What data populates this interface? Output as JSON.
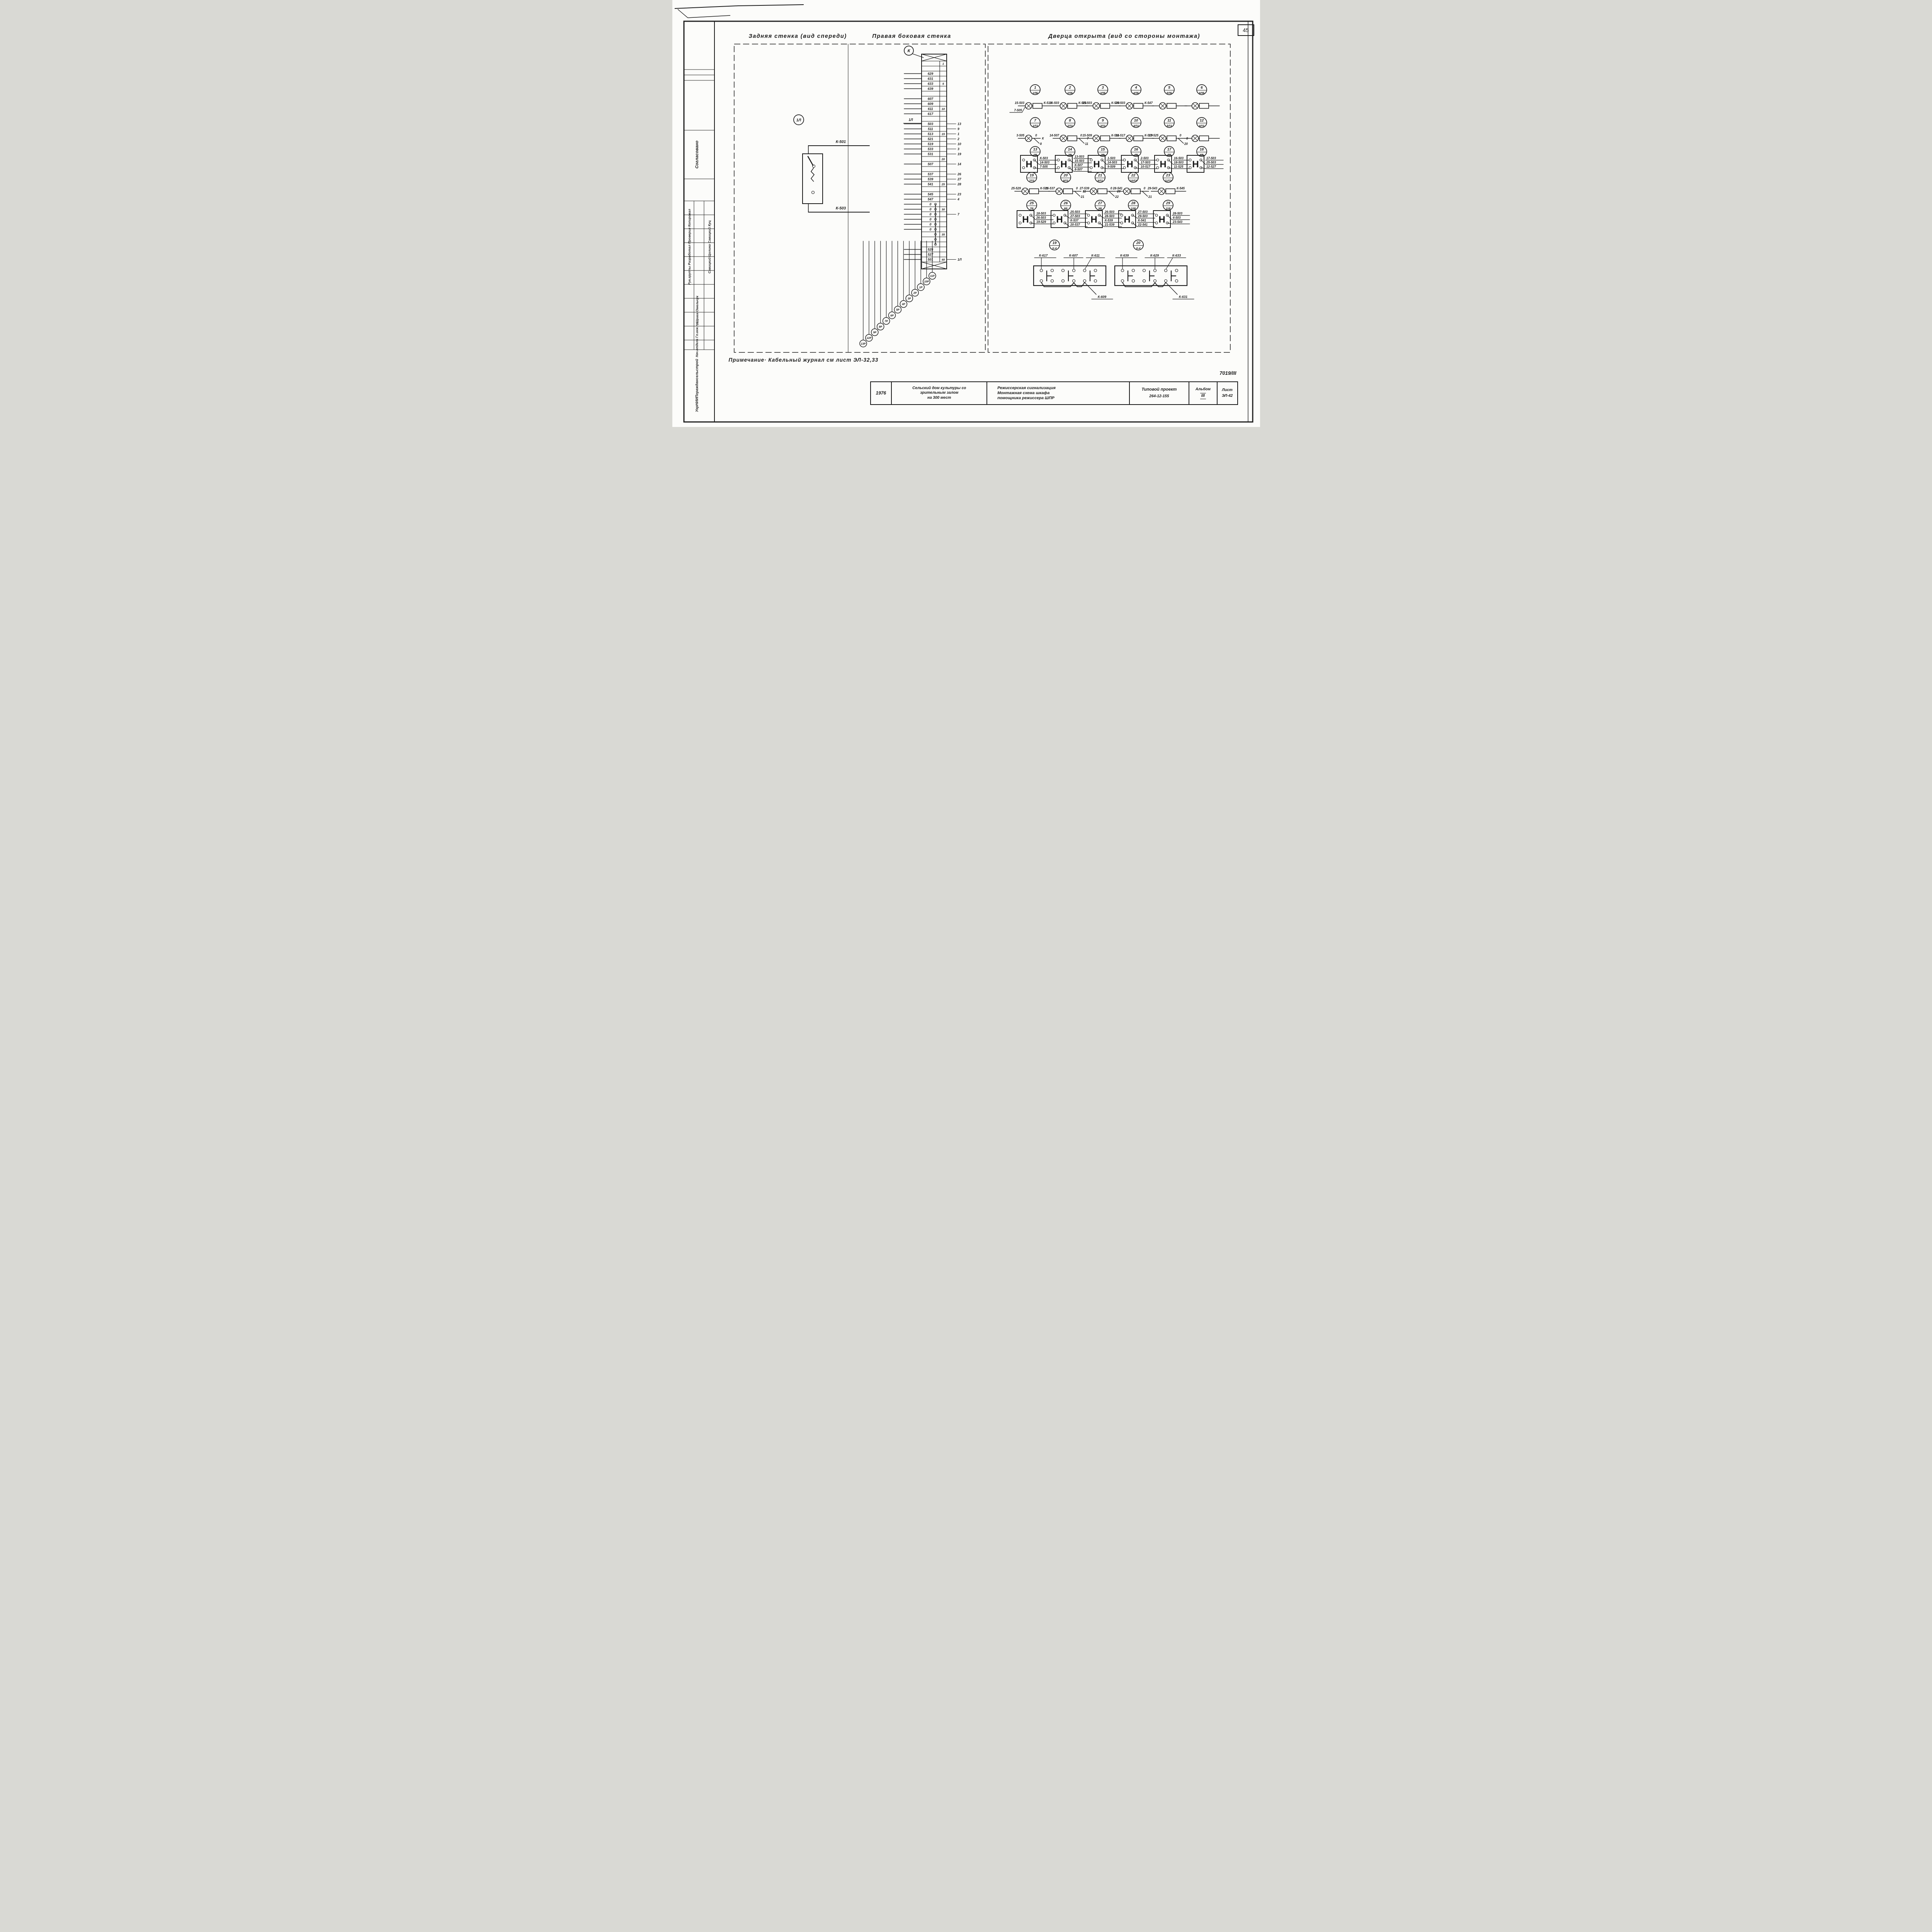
{
  "page": {
    "number": "45",
    "doc_code": "7019/III",
    "note": "Примечание·  Кабельный журнал  см лист ЭЛ-32,33"
  },
  "section_titles": [
    "Задняя стенка (вид спереди)",
    "Правая боковая стенка",
    "Дверца открыта (вид со стороны монтажа)"
  ],
  "back_wall": {
    "feeder_circle": "1Л",
    "wire_top": "К-501",
    "wire_bottom": "К-503"
  },
  "side_wall": {
    "connector_circle": "К",
    "strip_side_label": "1Л",
    "terminals": [
      {
        "i": "1"
      },
      {},
      {
        "t": "629"
      },
      {
        "t": "631"
      },
      {
        "t": "633",
        "i": "5"
      },
      {
        "t": "639"
      },
      {},
      {
        "t": "607"
      },
      {
        "t": "609"
      },
      {
        "t": "611",
        "i": "10"
      },
      {
        "t": "617"
      },
      {},
      {
        "t": "503",
        "r": "13"
      },
      {
        "t": "511",
        "r": "9"
      },
      {
        "t": "513",
        "i": "15",
        "r": "1"
      },
      {
        "t": "521",
        "r": "2"
      },
      {
        "t": "519",
        "r": "10"
      },
      {
        "t": "533",
        "r": "3"
      },
      {
        "t": "531",
        "r": "19"
      },
      {
        "i": "20"
      },
      {
        "t": "507",
        "r": "14"
      },
      {},
      {
        "t": "537",
        "r": "26"
      },
      {
        "t": "539",
        "r": "27"
      },
      {
        "t": "541",
        "i": "25",
        "r": "28"
      },
      {},
      {
        "t": "545",
        "r": "23"
      },
      {
        "t": "547",
        "r": "4"
      },
      {
        "t": "0",
        "j": 1
      },
      {
        "t": "0",
        "i": "30",
        "j": 1
      },
      {
        "t": "0",
        "r": "7",
        "j": 1
      },
      {
        "t": "0",
        "j": 1
      },
      {
        "t": "0",
        "j": 1
      },
      {
        "t": "0",
        "j": 1
      },
      {
        "i": "35",
        "j": 1
      },
      {
        "j": 1
      },
      {
        "j": 1
      },
      {
        "t": "525"
      },
      {
        "t": "527"
      },
      {
        "t": "501",
        "i": "40",
        "r": "1Л"
      }
    ],
    "cable_tags": [
      "13Р",
      "12Р",
      "9Р",
      "8Р",
      "7Р",
      "6Р",
      "5Р",
      "4Р",
      "3Р",
      "2Р",
      "1Р",
      "10Р",
      "11Р"
    ]
  },
  "door": {
    "h_letter": "Н",
    "circle_rows": [
      [
        {
          "n": "1",
          "c": "1ЛБ"
        },
        {
          "n": "2",
          "c": "2ЛБ"
        },
        {
          "n": "3",
          "c": "3ЛБ"
        },
        {
          "n": "4",
          "c": "4ЛБ"
        },
        {
          "n": "5",
          "c": "5ЛБ"
        },
        {
          "n": "6",
          "c": "6ЛБ"
        }
      ],
      [
        {
          "n": "7",
          "c": "1ЛЗ"
        },
        {
          "n": "8",
          "c": "2ЛЗ"
        },
        {
          "n": "9",
          "c": "3ЛЗ"
        },
        {
          "n": "10",
          "c": "4ЛЗ"
        },
        {
          "n": "11",
          "c": "5ЛЗ"
        },
        {
          "n": "12",
          "c": "6ЛЗ"
        }
      ],
      [
        {
          "n": "13",
          "c": "1В"
        },
        {
          "n": "14",
          "c": "2В"
        },
        {
          "n": "15",
          "c": "3В"
        },
        {
          "n": "16",
          "c": "4В"
        },
        {
          "n": "17",
          "c": "5В"
        },
        {
          "n": "18",
          "c": "6В"
        }
      ],
      [
        {
          "n": "19",
          "c": "7ЛЗ"
        },
        {
          "n": "20",
          "c": "8ЛЗ"
        },
        {
          "n": "21",
          "c": "9ЛЗ"
        },
        {
          "n": "22",
          "c": "10ЛЗ"
        },
        {
          "n": "23",
          "c": "11ЛЗ"
        }
      ],
      [
        {
          "n": "25",
          "c": "7В"
        },
        {
          "n": "26",
          "c": "8В"
        },
        {
          "n": "27",
          "c": "9В"
        },
        {
          "n": "28",
          "c": "10В"
        },
        {
          "n": "29",
          "c": "11В"
        }
      ],
      [
        {
          "n": "19",
          "c": "К-4"
        },
        {
          "n": "20",
          "c": "К-4"
        }
      ]
    ],
    "lamp_chains": [
      [
        {
          "pre": "15-503",
          "pre2": "7-505",
          "box": 1,
          "post": "К-513"
        },
        {
          "pre": "16-503",
          "box": 1,
          "post": "К-521"
        },
        {
          "pre": "25-503",
          "box": 1,
          "post": "К-533"
        },
        {
          "pre": "29-503",
          "box": 1,
          "post": "К-547"
        },
        {
          "box": 1
        },
        {
          "box": 1
        }
      ],
      [
        {
          "pre": "3-505",
          "top": "0",
          "mid": "К",
          "bot": "8"
        },
        {
          "pre": "14-507",
          "box": 1,
          "top": "0",
          "mid": "7",
          "bot": "11"
        },
        {
          "pre": "15-509",
          "box": 1,
          "post": "К-511"
        },
        {
          "pre": "16-517",
          "box": 1,
          "post": "К-519"
        },
        {
          "pre": "17-525",
          "box": 1,
          "top": "0",
          "mid": "8",
          "bot": "20"
        },
        {
          "box": 1
        }
      ],
      [
        {
          "pre": "25-529",
          "box": 1,
          "post": "К-531"
        },
        {
          "pre": "26-537",
          "box": 1,
          "top": "0",
          "mid": "11",
          "bot": "21"
        },
        {
          "pre": "27-539",
          "box": 1,
          "top": "0",
          "mid": "20",
          "bot": "22"
        },
        {
          "pre": "28-541",
          "box": 1,
          "top": "0",
          "bot": "21"
        },
        {
          "pre": "29-543",
          "box": 1,
          "post": "К-545"
        }
      ]
    ],
    "h_blocks": [
      [
        [
          "К-503",
          "14-503",
          "7-505"
        ],
        [
          "13-503",
          "15-503",
          "К-507",
          "8-507"
        ],
        [
          "1-503",
          "14-503",
          "9-509"
        ],
        [
          "2-503",
          "17-503",
          "10-517"
        ],
        [
          "16-503",
          "18-503",
          "11-525"
        ],
        [
          "17-503",
          "25-503",
          "12-527"
        ]
      ],
      [
        [
          "18-503",
          "26-503",
          "19-529"
        ],
        [
          "25-503",
          "27-503",
          "К-537",
          "20-537"
        ],
        [
          "26-503",
          "28-503",
          "К-539",
          "21-539"
        ],
        [
          "27-503",
          "29-503",
          "К-541",
          "22-541"
        ],
        [
          "28-503",
          "4-503",
          "23-543"
        ]
      ]
    ],
    "connector_blocks": [
      {
        "top": [
          "К-617",
          "К-607",
          "К-611"
        ],
        "bottom": "К-609"
      },
      {
        "top": [
          "К-639",
          "К-629",
          "К-633"
        ],
        "bottom": "К-631"
      }
    ]
  },
  "title_block": {
    "year": "1976",
    "object_lines": [
      "Сельский дом культуры со",
      "зрительным залом",
      "на 300 мест"
    ],
    "drawing_lines": [
      "Режиссерская сигнализация",
      "Монтажная схема шкафа",
      "помощника режиссера ШПР"
    ],
    "project_label": "Типовой проект",
    "project_no": "264-12-155",
    "album_label": "Альбом",
    "album_no": "III",
    "sheet_label": "Лист",
    "sheet_no": "ЭЛ-42"
  },
  "sidebar": {
    "agreed": "Согласовано",
    "roles": "Рук.группы   Разработал   Проверил   Копировал",
    "names": "Савицкий   Цолина   Савицкий   Куц",
    "staff": "Шрага   Омельчук",
    "chiefs": "Нач.отдела   Гл.инж.пр.",
    "org": "УкрНИИПграждансельстрой"
  }
}
